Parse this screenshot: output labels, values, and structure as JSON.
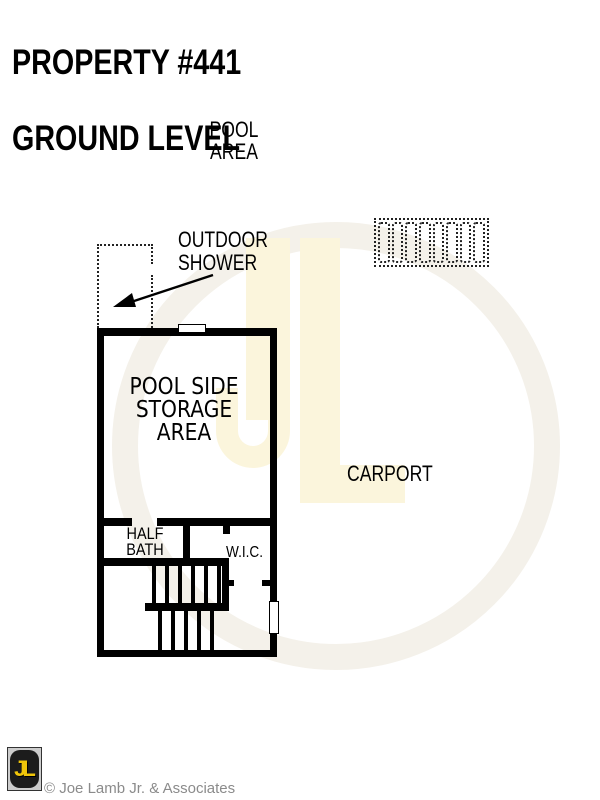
{
  "title": {
    "line1": "PROPERTY #441",
    "line2": "GROUND LEVEL"
  },
  "plan_labels": {
    "pool_area": "POOL\nAREA",
    "outdoor_shower": "OUTDOOR\nSHOWER",
    "pool_side_storage": "POOL SIDE\nSTORAGE\nAREA",
    "half_bath": "HALF\nBATH",
    "wic": "W.I.C.",
    "carport": "CARPORT"
  },
  "footer": {
    "logo_text": "JL",
    "copyright": "© Joe Lamb Jr. & Associates"
  },
  "colors": {
    "wall": "#000000",
    "watermark_yellow": "#fbf5dc",
    "watermark_ring": "#f4f1ea",
    "logo_yellow": "#f0c60a",
    "copyright_gray": "#8b8b8b"
  }
}
